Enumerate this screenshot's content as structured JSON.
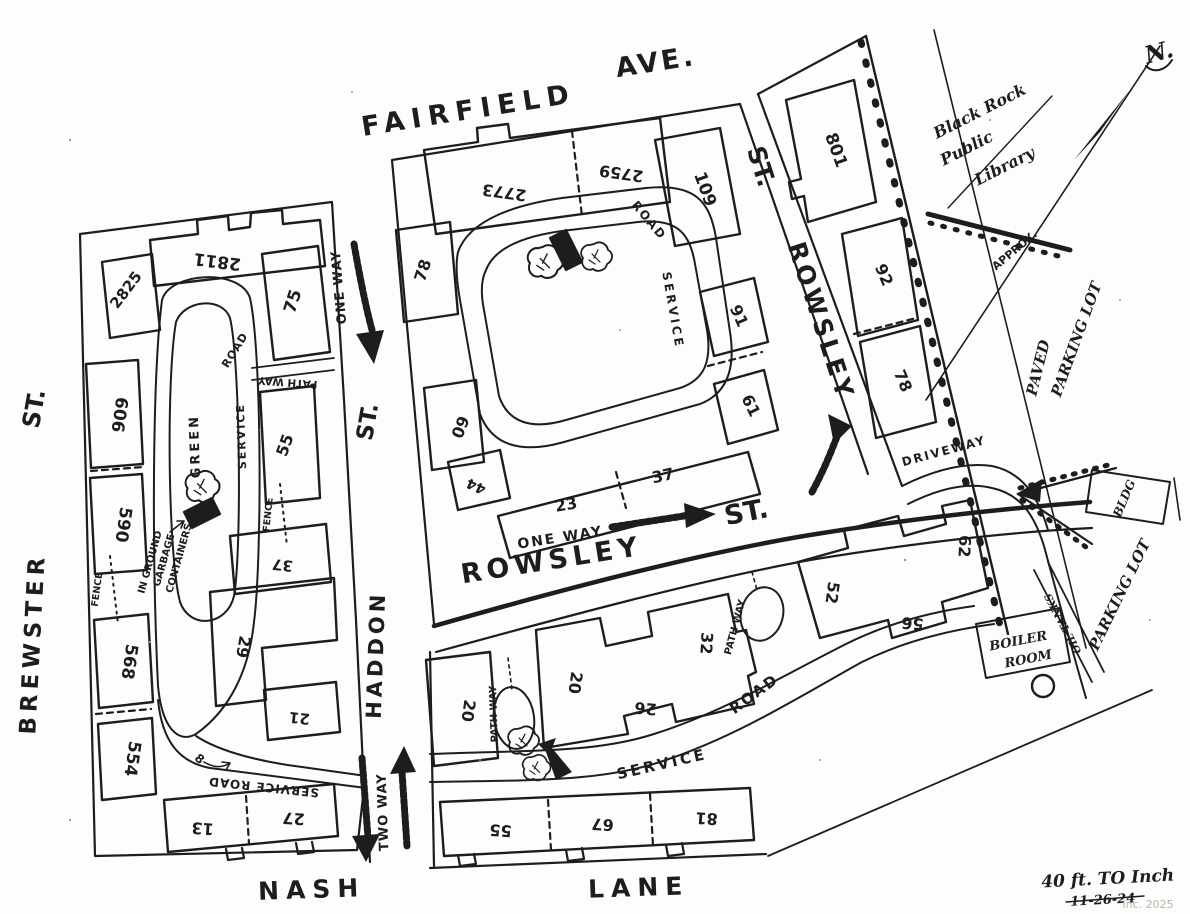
{
  "streets": {
    "fairfield": "FAIRFIELD",
    "ave": "AVE.",
    "brewster": "BREWSTER",
    "haddon": "HADDON",
    "rowsley": "ROWSLEY",
    "nash": "NASH",
    "lane": "LANE",
    "st": "ST."
  },
  "traffic": {
    "one_way": "ONE WAY",
    "two_way": "TWO WAY"
  },
  "roads": {
    "service": "SERVICE",
    "road": "ROAD",
    "service_road": "SERVICE ROAD",
    "path_way": "PATH WAY",
    "driveway": "DRIVEWAY"
  },
  "features": {
    "green": "GREEN",
    "fence": "FENCE",
    "in_ground": "IN GROUND",
    "garbage": "GARBAGE",
    "containers": "CONTAINERS",
    "boiler": "BOILER",
    "room": "ROOM",
    "oil_tanks": "OIL TANKS",
    "parking_lot": "PARKING LOT",
    "paved": "PAVED",
    "bldg": "BLDG",
    "approx": "APPROX.",
    "eight": "8",
    "north": "N."
  },
  "annotations": {
    "library1": "Black Rock",
    "library2": "Public",
    "library3": "Library",
    "scale": "40 ft. TO Inch",
    "date": "11-26-24",
    "watermark": "Inc. 2025"
  },
  "buildings": {
    "west": {
      "b2811": "2811",
      "b2825": "2825",
      "b75": "75",
      "b606": "606",
      "b590": "590",
      "b55": "55",
      "b37": "37",
      "b29": "29",
      "b21": "21",
      "b568": "568",
      "b554": "554",
      "b13": "13",
      "b27": "27"
    },
    "center": {
      "b2773": "2773",
      "b2759": "2759",
      "b109": "109",
      "b78": "78",
      "b60": "60",
      "b44": "44",
      "b23": "23",
      "b37": "37",
      "b91": "91",
      "b61": "61"
    },
    "east": {
      "b801": "801",
      "b92": "92",
      "b78": "78"
    },
    "south": {
      "b20w": "20",
      "b20": "20",
      "b26": "26",
      "b32": "32",
      "b52": "52",
      "b56": "56",
      "b62": "62",
      "b55": "55",
      "b67": "67",
      "b81": "81"
    }
  },
  "colors": {
    "ink": "#1d1d1d",
    "paper": "#fdfdfb",
    "watermark": "#b5b5b1"
  }
}
